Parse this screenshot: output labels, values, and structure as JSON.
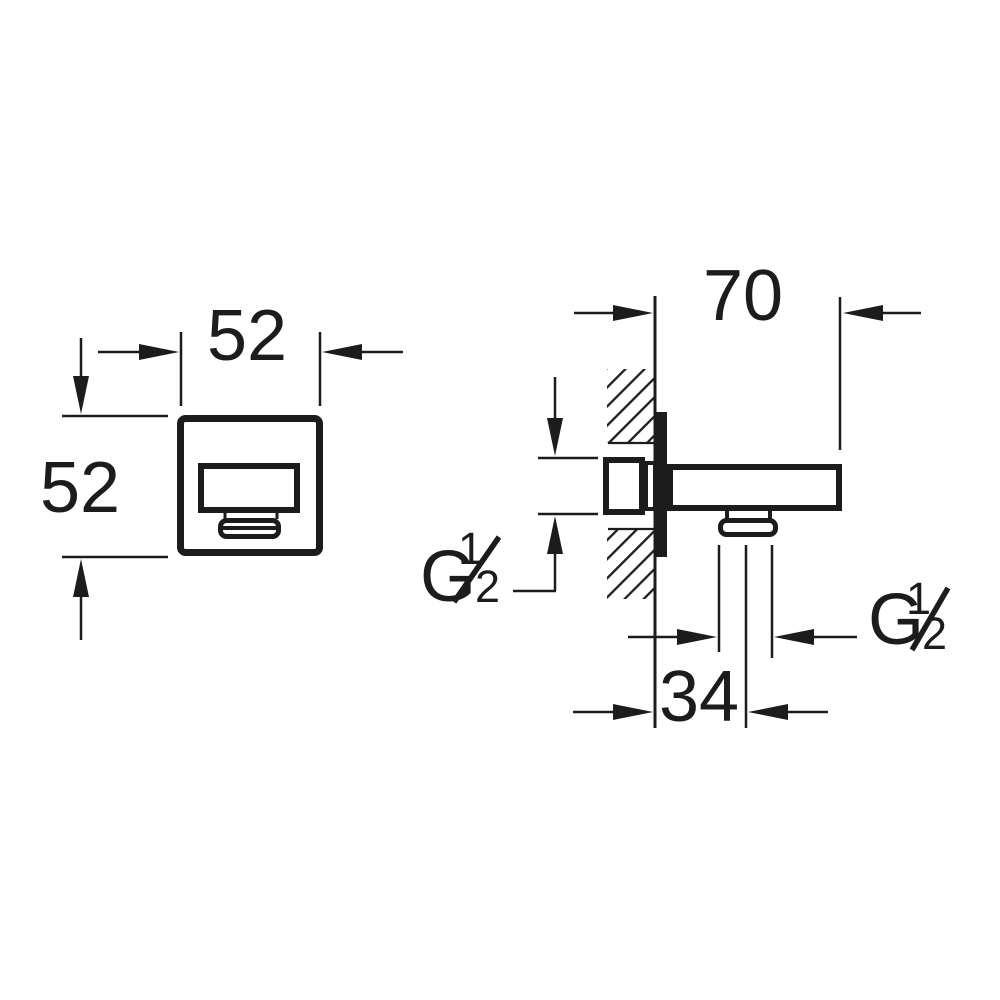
{
  "colors": {
    "ink": "#1c1c1c",
    "background": "#ffffff"
  },
  "front_view": {
    "width_label": "52",
    "height_label": "52"
  },
  "side_view": {
    "depth_label": "70",
    "outlet_offset_label": "34",
    "inlet_thread": {
      "prefix": "G",
      "numerator": "1",
      "denominator": "2"
    },
    "outlet_thread": {
      "prefix": "G",
      "numerator": "1",
      "denominator": "2"
    }
  }
}
